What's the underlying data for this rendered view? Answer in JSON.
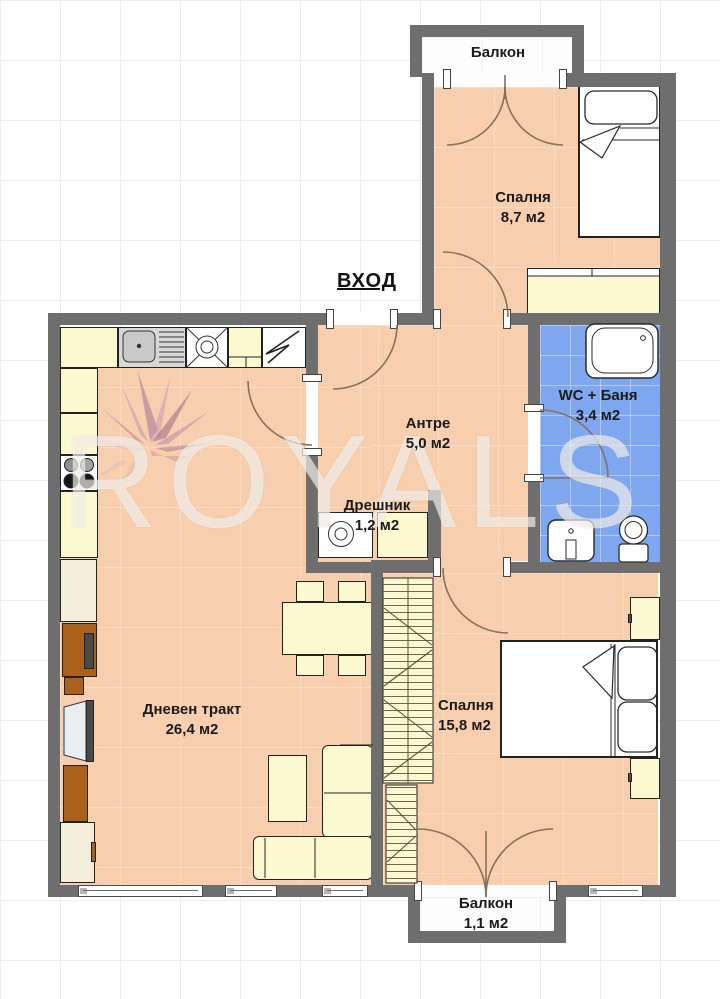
{
  "watermark": {
    "text": "ROYALS"
  },
  "entrance": {
    "label": "ВХОД"
  },
  "rooms": {
    "balcony_top": {
      "name": "Балкон"
    },
    "bedroom_top": {
      "name": "Спалня",
      "area": "8,7 м2"
    },
    "hallway": {
      "name": "Антре",
      "area": "5,0 м2"
    },
    "bathroom": {
      "name": "WC + Баня",
      "area": "3,4 м2"
    },
    "closet": {
      "name": "Дрешник",
      "area": "1,2 м2"
    },
    "living": {
      "name": "Дневен тракт",
      "area": "26,4 м2"
    },
    "bedroom_bottom": {
      "name": "Спалня",
      "area": "15,8 м2"
    },
    "balcony_bottom": {
      "name": "Балкон",
      "area": "1,1 м2"
    }
  },
  "colors": {
    "wall": "#6e6e6e",
    "room_fill": "#f8cfae",
    "bathroom_fill": "#7fa7ef",
    "furniture_yellow": "#fcf9d1",
    "furniture_brown": "#a9611c",
    "watermark_flower": "#a8709a"
  }
}
